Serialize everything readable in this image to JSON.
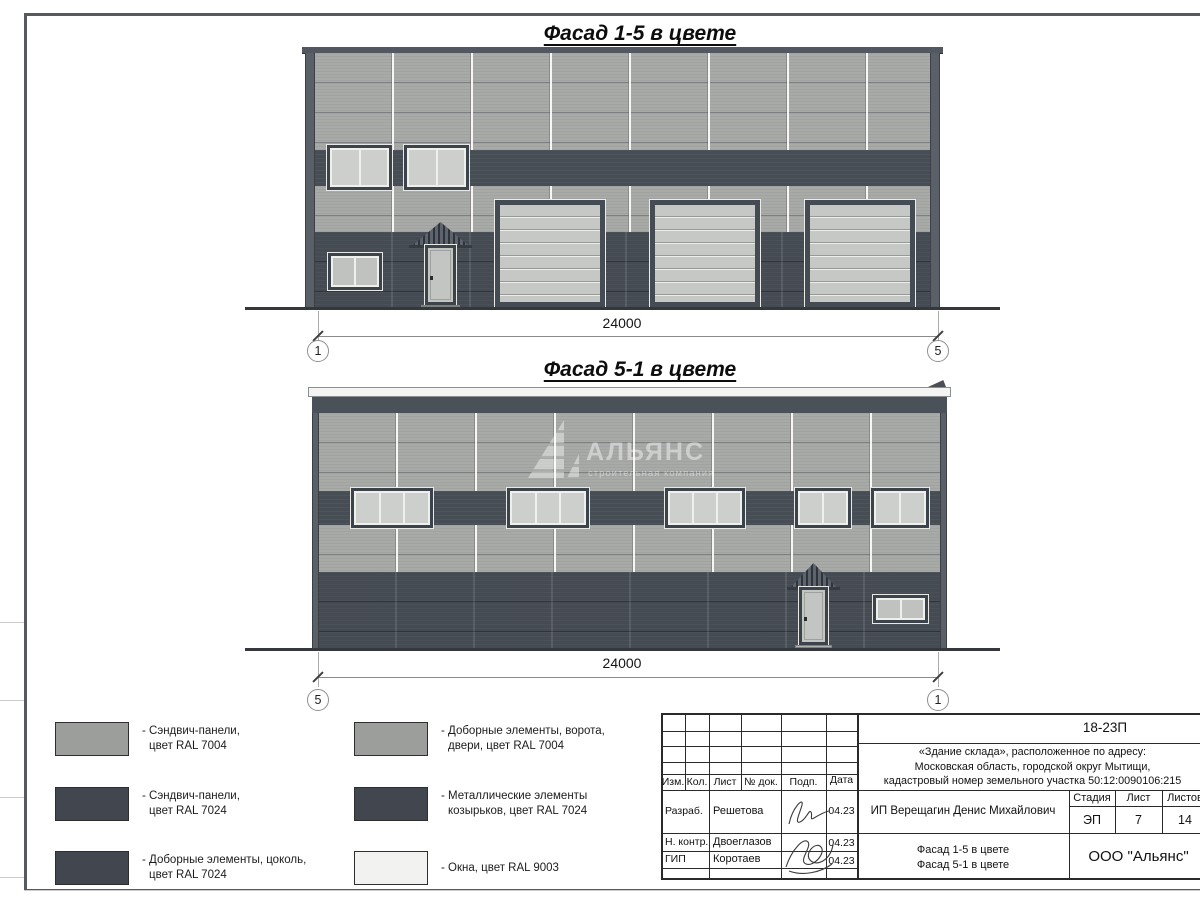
{
  "facade1": {
    "title": "Фасад 1-5 в цвете",
    "dimension": "24000",
    "axis_left": "1",
    "axis_right": "5"
  },
  "facade2": {
    "title": "Фасад 5-1 в цвете",
    "dimension": "24000",
    "axis_left": "5",
    "axis_right": "1",
    "watermark": {
      "name": "АЛЬЯНС",
      "subtitle": "строительная компания"
    }
  },
  "legend": {
    "items": [
      {
        "color": "#9b9e9b",
        "line1": "- Сэндвич-панели,",
        "line2": "цвет RAL 7004"
      },
      {
        "color": "#42474f",
        "line1": "- Сэндвич-панели,",
        "line2": "цвет RAL 7024"
      },
      {
        "color": "#42474f",
        "line1": "- Доборные элементы, цоколь,",
        "line2": "цвет RAL 7024"
      },
      {
        "color": "#9b9e9b",
        "line1": "- Доборные элементы, ворота,",
        "line2": "двери, цвет RAL 7004"
      },
      {
        "color": "#42474f",
        "line1": "- Металлические элементы",
        "line2": "козырьков, цвет RAL 7024"
      },
      {
        "color": "#f2f3f1",
        "line1": "- Окна, цвет RAL 9003",
        "line2": ""
      }
    ]
  },
  "titleblock": {
    "code": "18-23П",
    "object_lines": [
      "«Здание склада», расположенное по адресу:",
      "Московская область, городской округ Мытищи,",
      "кадастровый номер земельного участка 50:12:0090106:215"
    ],
    "headers": {
      "izm": "Изм.",
      "kol": "Кол.",
      "list": "Лист",
      "doc": "№ док.",
      "podp": "Подп.",
      "date": "Дата"
    },
    "rows": [
      {
        "role": "Разраб.",
        "name": "Решетова",
        "date": "04.23"
      },
      {
        "role": "Н. контр.",
        "name": "Двоеглазов",
        "date": "04.23"
      },
      {
        "role": "ГИП",
        "name": "Коротаев",
        "date": "04.23"
      }
    ],
    "client": "ИП Верещагин Денис Михайлович",
    "stage_label": "Стадия",
    "sheet_label": "Лист",
    "sheets_label": "Листов",
    "stage": "ЭП",
    "sheet_no": "7",
    "sheets_total": "14",
    "drawing_title_line1": "Фасад 1-5 в цвете",
    "drawing_title_line2": "Фасад 5-1 в цвете",
    "company": "ООО \"Альянс\""
  },
  "colors": {
    "panels_light_ral7004": "#a8aaa7",
    "panels_dark_ral7024": "#474d55",
    "plinth_ral7024": "#454b53",
    "windows_ral9003": "#f2f3f1",
    "gate_leaf": "#c6c8c5",
    "frame_dark": "#3d434b"
  }
}
